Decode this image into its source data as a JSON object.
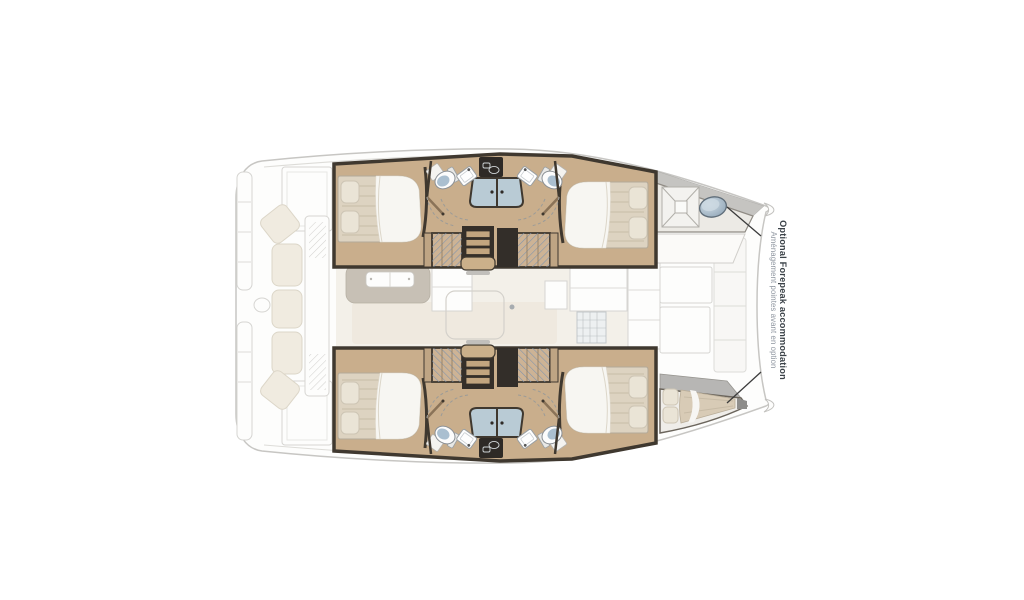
{
  "annotation": {
    "title": "Optional Forepeak accommodation",
    "subtitle": "Aménagement pointes avant en option"
  },
  "colors": {
    "background": "#ffffff",
    "hull_floor_wood": "#c9ae8c",
    "wall_dark": "#3f382f",
    "door_wood": "#8a7358",
    "bed_mattress": "#ddd3c1",
    "bed_sheet": "#f7f6f2",
    "pillow": "#eae4d6",
    "wardrobe_hatch_lines": "#7d93ad",
    "shower_glass": "#b9cbd5",
    "toilet_seat": "#aabfd0",
    "forepeak_hatch_oval": "#a9bcca",
    "deck_gray": "#c5c4c1",
    "granite_step": "#b7b6b4",
    "faded_outline": "#d6d5d2",
    "salon_floor": "#f3f0e9",
    "cockpit_cushion": "#f0ebe0",
    "annotation_title": "#3b4248",
    "annotation_subtitle": "#8f96a0",
    "leader_line": "#3c3c3c"
  }
}
